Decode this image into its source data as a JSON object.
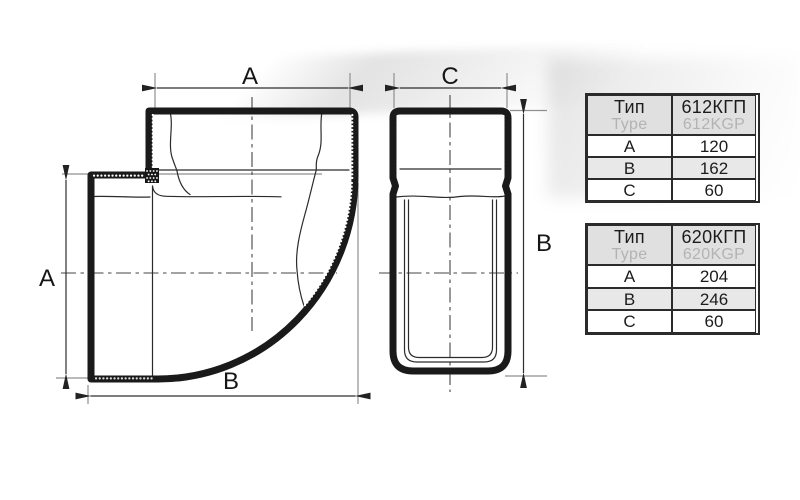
{
  "drawing": {
    "description": "90-degree flat duct elbow technical drawing, side section view and front view",
    "labels": {
      "side_top": "A",
      "side_left": "A",
      "side_bottom": "B",
      "front_top": "C",
      "front_right": "B"
    }
  },
  "tables": [
    {
      "id": "612",
      "header": {
        "type_primary": "Тип",
        "type_secondary": "Type",
        "model_primary": "612КГП",
        "model_secondary": "612KGP"
      },
      "rows": [
        {
          "param": "A",
          "value": "120"
        },
        {
          "param": "B",
          "value": "162"
        },
        {
          "param": "C",
          "value": "60"
        }
      ]
    },
    {
      "id": "620",
      "header": {
        "type_primary": "Тип",
        "type_secondary": "Type",
        "model_primary": "620КГП",
        "model_secondary": "620KGP"
      },
      "rows": [
        {
          "param": "A",
          "value": "204"
        },
        {
          "param": "B",
          "value": "246"
        },
        {
          "param": "C",
          "value": "60"
        }
      ]
    }
  ],
  "colors": {
    "line": "#1a1a1a",
    "table_border": "#2b2b2b",
    "header_bg": "#e0e0e0",
    "alt_row_bg": "#e8e8e8",
    "secondary_text": "#b3b3b3"
  }
}
